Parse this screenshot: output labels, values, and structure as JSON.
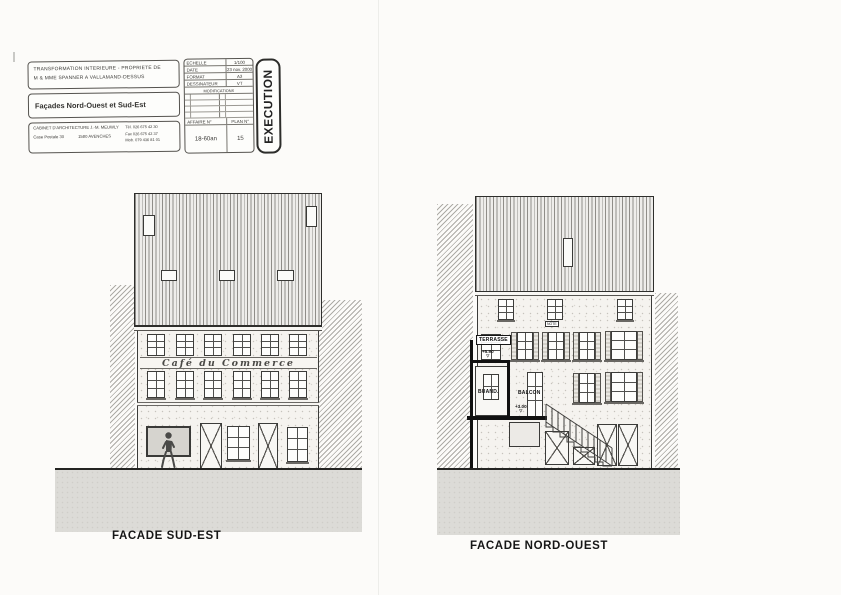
{
  "colors": {
    "paper": "#fcfbf9",
    "ink": "#2e2e2e",
    "ground_shading": "#dcdbd7",
    "hatch_line": "#adaba6",
    "new_construction": "#111111"
  },
  "icons": {
    "level_mark": "▽"
  },
  "title_block": {
    "project_line1": "TRANSFORMATION INTERIEURE - PROPRIETE DE",
    "project_line2": "M & MME SPANNER A VALLAMAND-DESSUS",
    "drawing_title": "Façades Nord-Ouest et Sud-Est",
    "architect": {
      "name": "CABINET D'ARCHITECTURE J.-M. MEUWLY",
      "address_line1": "Case Postale 30",
      "address_line2": "1580 AVENCHES",
      "tel": "Tél. 026 675 42 30",
      "fax": "Fax 026 675 42 37",
      "mob": "Mob. 079 436 81 01"
    },
    "info": {
      "scale_label": "ECHELLE",
      "scale_value": "1/100",
      "date_label": "DATE",
      "date_value": "23 nov. 2000",
      "format_label": "FORMAT",
      "format_value": "A3",
      "draftsman_label": "DESSINATEUR",
      "draftsman_value": "VT",
      "modifications_label": "MODIFICATIONS",
      "affaire_label": "AFFAIRE N°",
      "affaire_value": "18-60an",
      "plan_label": "PLAN N°",
      "plan_value": "15"
    },
    "stamp": "EXECUTION"
  },
  "facade_sud_est": {
    "label": "FACADE SUD-EST",
    "sign": "Café du Commerce"
  },
  "facade_nord_ouest": {
    "label": "FACADE NORD-OUEST",
    "terrasse_label": "TERRASSE",
    "terrasse_level": "+5.90",
    "buanderie_label": "BUAND.",
    "balcon_label": "BALCON",
    "balcon_level": "+3.00",
    "note_label": "NOTE"
  }
}
